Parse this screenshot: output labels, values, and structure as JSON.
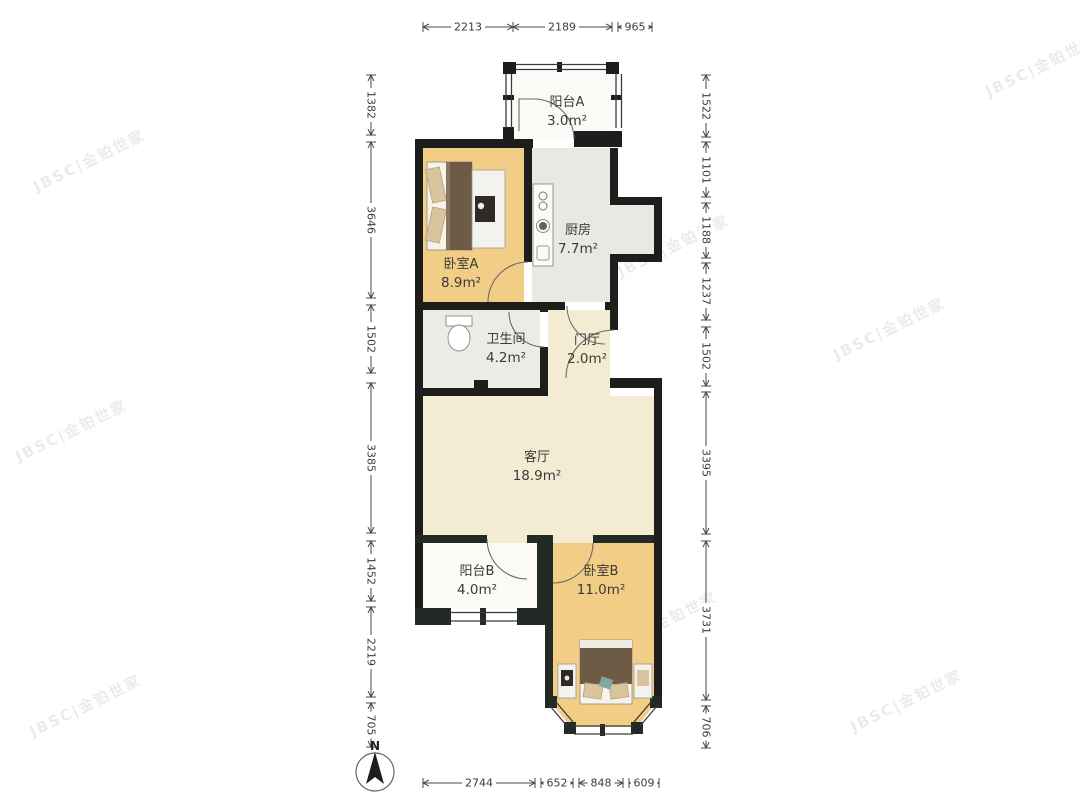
{
  "watermark": {
    "text": "JBSC|金铂世家"
  },
  "compass": {
    "label": "N"
  },
  "rooms": [
    {
      "name": "阳台A",
      "area": "3.0m²"
    },
    {
      "name": "厨房",
      "area": "7.7m²"
    },
    {
      "name": "卧室A",
      "area": "8.9m²"
    },
    {
      "name": "卫生间",
      "area": "4.2m²"
    },
    {
      "name": "门厅",
      "area": "2.0m²"
    },
    {
      "name": "客厅",
      "area": "18.9m²"
    },
    {
      "name": "阳台B",
      "area": "4.0m²"
    },
    {
      "name": "卧室B",
      "area": "11.0m²"
    }
  ],
  "dimensions": {
    "top": [
      "2213",
      "2189",
      "965"
    ],
    "bottom": [
      "2744",
      "652",
      "848",
      "609"
    ],
    "left": [
      "1382",
      "3646",
      "1502",
      "3385",
      "1452",
      "2219",
      "705"
    ],
    "right": [
      "1522",
      "1101",
      "1188",
      "1237",
      "1502",
      "3395",
      "3731",
      "706"
    ]
  },
  "colors": {
    "wall": "#1d1d1b",
    "lower_wall": "#232a25",
    "bedroom_floor": "#f1cd86",
    "kitchen_floor": "#e9e8e3",
    "bathroom_floor": "#ecebe5",
    "living_floor": "#f4ecd2",
    "balcony_floor": "#fbfaf6",
    "blanket": "#6e5b46",
    "pillow": "#d9c49c",
    "teal_accent": "#7fa8a2",
    "dim_text": "#3d3d3d"
  }
}
